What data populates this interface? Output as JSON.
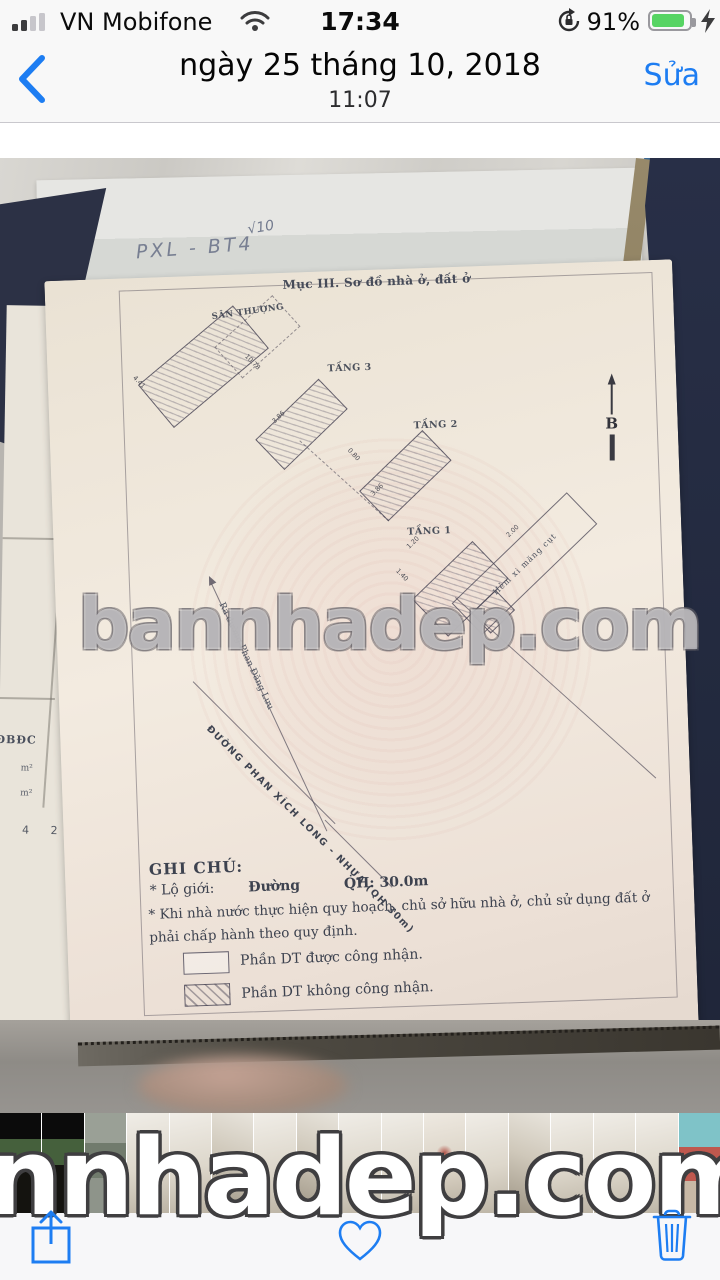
{
  "status_bar": {
    "carrier": "VN Mobifone",
    "time": "17:34",
    "battery": "91%"
  },
  "nav": {
    "title": "ngày 25 tháng 10, 2018",
    "subtitle": "11:07",
    "edit": "Sửa"
  },
  "doc": {
    "section_title": "Mục III. Sơ đồ nhà ở, đất ở",
    "handwriting_check": "√10",
    "handwriting": "PXL - BT4",
    "left_fragment": {
      "label": "BĐBĐC",
      "unit1": "m²",
      "unit2": "m²",
      "digits": "0 4 2 7"
    },
    "plans": {
      "roof": "SÂN THƯỢNG",
      "floor3": "TẦNG 3",
      "floor2": "TẦNG 2",
      "floor1": "TẦNG 1",
      "alley": "Hẻm xi măng cụt",
      "north": "B"
    },
    "dims": [
      "4.41",
      "10.78",
      "3.86",
      "0.80",
      "1.20",
      "1.40",
      "2.00",
      "3.86"
    ],
    "street_rear": "Ra đường Phan Đăng Lưu",
    "street_front": "ĐƯỜNG PHAN XÍCH LONG - NHỰA (QH 30m)",
    "notes": {
      "heading": "GHI CHÚ:",
      "item1_label": "* Lộ giới:",
      "item1_road": "Đường",
      "item1_value": "QH: 30.0m",
      "item2_line1": "* Khi nhà nước thực hiện quy hoạch, chủ sở hữu nhà ở, chủ sử dụng đất ở",
      "item2_line2": "phải chấp hành theo quy định.",
      "legend_recognized": "Phần DT được công nhận.",
      "legend_unrecognized": "Phần DT không công nhận."
    },
    "watermark": "bannhadep.com"
  },
  "thumbs": [
    {
      "kind": "exterior"
    },
    {
      "kind": "exterior"
    },
    {
      "kind": "building"
    },
    {
      "kind": "document"
    },
    {
      "kind": "document"
    },
    {
      "kind": "document-dark"
    },
    {
      "kind": "document"
    },
    {
      "kind": "document-dark"
    },
    {
      "kind": "document"
    },
    {
      "kind": "document"
    },
    {
      "kind": "document-stamp"
    },
    {
      "kind": "document"
    },
    {
      "kind": "document-dark"
    },
    {
      "kind": "document"
    },
    {
      "kind": "document"
    },
    {
      "kind": "document"
    },
    {
      "kind": "colorful"
    }
  ],
  "bottom_watermark": "nnhadep.com",
  "colors": {
    "accent": "#1d7df2",
    "battery_green": "#57d463"
  }
}
